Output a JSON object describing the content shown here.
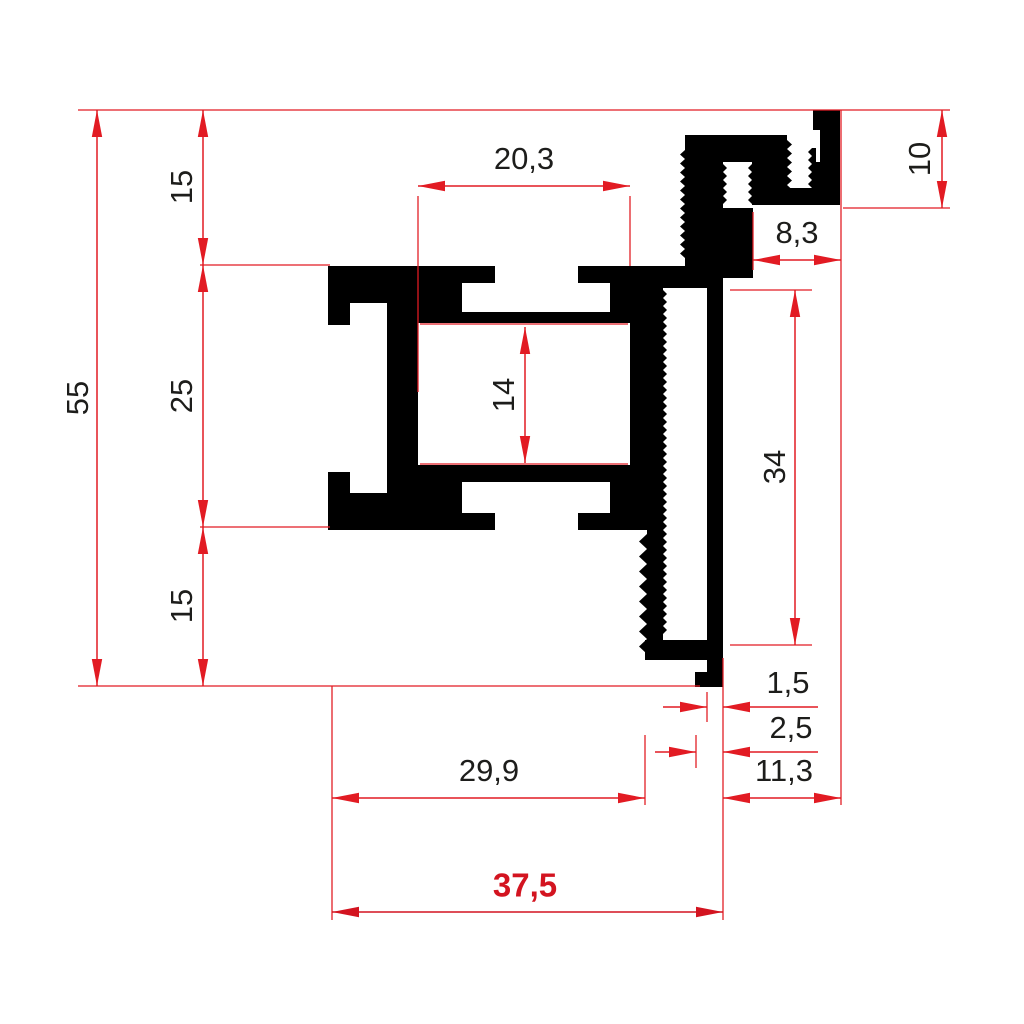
{
  "drawing": {
    "description": "Technical cross-section drawing of an extruded aluminum profile with red dimension lines",
    "units": "mm",
    "colors": {
      "dimension_red": "#e21b23",
      "highlight_red": "#d31420",
      "profile_black": "#000000",
      "label_black": "#1d1d1b",
      "background": "#ffffff"
    },
    "stroke_width": 1.5,
    "arrow": {
      "length": 27,
      "half_width": 5.2
    },
    "font_size": 31,
    "font_size_bold": 33
  },
  "profile": {
    "rects": [
      [
        328,
        266,
        74,
        37
      ],
      [
        328,
        303,
        22,
        22
      ],
      [
        387,
        303,
        15,
        22
      ],
      [
        328,
        472,
        22,
        21
      ],
      [
        387,
        472,
        15,
        21
      ],
      [
        328,
        493,
        74,
        37
      ],
      [
        387,
        266,
        31,
        264
      ],
      [
        418,
        266,
        44,
        57
      ],
      [
        462,
        266,
        33,
        17
      ],
      [
        462,
        312,
        148,
        11
      ],
      [
        578,
        266,
        32,
        17
      ],
      [
        610,
        266,
        45,
        57
      ],
      [
        418,
        465,
        44,
        65
      ],
      [
        462,
        465,
        148,
        17
      ],
      [
        462,
        513,
        33,
        17
      ],
      [
        578,
        513,
        32,
        17
      ],
      [
        610,
        465,
        45,
        65
      ],
      [
        630,
        266,
        33,
        264
      ],
      [
        647,
        530,
        16,
        115
      ],
      [
        663,
        266,
        47,
        22
      ],
      [
        707,
        278,
        16,
        409
      ],
      [
        645,
        640,
        78,
        20
      ],
      [
        695,
        672,
        12,
        15
      ],
      [
        685,
        135,
        102,
        27
      ],
      [
        685,
        162,
        38,
        116
      ],
      [
        723,
        208,
        30,
        70
      ],
      [
        752,
        162,
        35,
        43
      ],
      [
        813,
        110,
        27,
        20
      ],
      [
        820,
        130,
        20,
        32
      ],
      [
        812,
        162,
        28,
        26
      ],
      [
        777,
        188,
        63,
        17
      ]
    ],
    "serrations": [
      {
        "x": 685,
        "y1": 150,
        "y2": 264,
        "side": -1,
        "amp": 5,
        "pitch": 9
      },
      {
        "x": 723,
        "y1": 164,
        "y2": 208,
        "side": 1,
        "amp": 4,
        "pitch": 8
      },
      {
        "x": 752,
        "y1": 164,
        "y2": 204,
        "side": -1,
        "amp": 4,
        "pitch": 8
      },
      {
        "x": 787,
        "y1": 140,
        "y2": 204,
        "side": 1,
        "amp": 5,
        "pitch": 9
      },
      {
        "x": 812,
        "y1": 148,
        "y2": 188,
        "side": -1,
        "amp": 4,
        "pitch": 8
      },
      {
        "x": 663,
        "y1": 290,
        "y2": 639,
        "side": 1,
        "amp": 4,
        "pitch": 8
      },
      {
        "x": 647,
        "y1": 534,
        "y2": 654,
        "side": -1,
        "amp": 8,
        "pitch": 15
      }
    ]
  },
  "extension_lines": [
    {
      "x1": 78,
      "y1": 110,
      "x2": 950,
      "y2": 110
    },
    {
      "x1": 78,
      "y1": 686,
      "x2": 700,
      "y2": 686
    },
    {
      "x1": 200,
      "y1": 265,
      "x2": 330,
      "y2": 265
    },
    {
      "x1": 200,
      "y1": 527,
      "x2": 330,
      "y2": 527
    },
    {
      "x1": 418,
      "y1": 196,
      "x2": 418,
      "y2": 392
    },
    {
      "x1": 630,
      "y1": 196,
      "x2": 630,
      "y2": 266
    },
    {
      "x1": 420,
      "y1": 324,
      "x2": 628,
      "y2": 324
    },
    {
      "x1": 420,
      "y1": 464,
      "x2": 628,
      "y2": 464
    },
    {
      "x1": 843,
      "y1": 208,
      "x2": 950,
      "y2": 208
    },
    {
      "x1": 753,
      "y1": 212,
      "x2": 753,
      "y2": 270
    },
    {
      "x1": 841,
      "y1": 110,
      "x2": 841,
      "y2": 805
    },
    {
      "x1": 730,
      "y1": 290,
      "x2": 812,
      "y2": 290
    },
    {
      "x1": 730,
      "y1": 645,
      "x2": 812,
      "y2": 645
    },
    {
      "x1": 707,
      "y1": 692,
      "x2": 707,
      "y2": 722
    },
    {
      "x1": 723,
      "y1": 658,
      "x2": 723,
      "y2": 920
    },
    {
      "x1": 696,
      "y1": 735,
      "x2": 696,
      "y2": 768
    },
    {
      "x1": 645,
      "y1": 735,
      "x2": 645,
      "y2": 805
    },
    {
      "x1": 332,
      "y1": 686,
      "x2": 332,
      "y2": 920
    }
  ],
  "dimensions": [
    {
      "name": "dim-55",
      "label": "55",
      "value": 55,
      "orient": "v",
      "x": 97,
      "y1": 110,
      "y2": 686,
      "style": "inside",
      "lx": 80,
      "ly": 398,
      "rot": true
    },
    {
      "name": "dim-15-top",
      "label": "15",
      "value": 15,
      "orient": "v",
      "x": 203,
      "y1": 110,
      "y2": 265,
      "style": "inside",
      "lx": 184,
      "ly": 187,
      "rot": true
    },
    {
      "name": "dim-25",
      "label": "25",
      "value": 25,
      "orient": "v",
      "x": 203,
      "y1": 265,
      "y2": 527,
      "style": "inside",
      "lx": 184,
      "ly": 396,
      "rot": true
    },
    {
      "name": "dim-15-bottom",
      "label": "15",
      "value": 15,
      "orient": "v",
      "x": 203,
      "y1": 527,
      "y2": 686,
      "style": "inside",
      "lx": 184,
      "ly": 606,
      "rot": true
    },
    {
      "name": "dim-20-3",
      "label": "20,3",
      "value": 20.3,
      "orient": "h",
      "y": 186,
      "x1": 418,
      "x2": 630,
      "style": "inside",
      "lx": 524,
      "ly": 161,
      "rot": false
    },
    {
      "name": "dim-14",
      "label": "14",
      "value": 14,
      "orient": "v",
      "x": 525,
      "y1": 327,
      "y2": 463,
      "style": "inside",
      "lx": 506,
      "ly": 395,
      "rot": true
    },
    {
      "name": "dim-10",
      "label": "10",
      "value": 10,
      "orient": "v",
      "x": 942,
      "y1": 110,
      "y2": 208,
      "style": "inside",
      "lx": 922,
      "ly": 159,
      "rot": true
    },
    {
      "name": "dim-8-3",
      "label": "8,3",
      "value": 8.3,
      "orient": "h",
      "y": 260,
      "x1": 753,
      "x2": 841,
      "style": "inside",
      "lx": 797,
      "ly": 235,
      "rot": false
    },
    {
      "name": "dim-34",
      "label": "34",
      "value": 34,
      "orient": "v",
      "x": 795,
      "y1": 290,
      "y2": 645,
      "style": "inside",
      "lx": 777,
      "ly": 467,
      "rot": true
    },
    {
      "name": "dim-1-5",
      "label": "1,5",
      "value": 1.5,
      "orient": "h",
      "y": 707,
      "x1": 707,
      "x2": 723,
      "style": "outside",
      "tail1": 663,
      "tail2": 818,
      "lx": 788,
      "ly": 685,
      "rot": false
    },
    {
      "name": "dim-2-5",
      "label": "2,5",
      "value": 2.5,
      "orient": "h",
      "y": 752,
      "x1": 696,
      "x2": 723,
      "style": "outside",
      "tail1": 655,
      "tail2": 818,
      "lx": 791,
      "ly": 730,
      "rot": false
    },
    {
      "name": "dim-11-3",
      "label": "11,3",
      "value": 11.3,
      "orient": "h",
      "y": 798,
      "x1": 723,
      "x2": 841,
      "style": "inside",
      "lx": 784,
      "ly": 773,
      "rot": false
    },
    {
      "name": "dim-29-9",
      "label": "29,9",
      "value": 29.9,
      "orient": "h",
      "y": 798,
      "x1": 332,
      "x2": 645,
      "style": "inside",
      "lx": 489,
      "ly": 773,
      "rot": false
    },
    {
      "name": "dim-37-5",
      "label": "37,5",
      "value": 37.5,
      "orient": "h",
      "y": 912,
      "x1": 332,
      "x2": 723,
      "style": "inside",
      "lx": 525,
      "ly": 888,
      "rot": false,
      "bold": true,
      "red": true
    }
  ]
}
